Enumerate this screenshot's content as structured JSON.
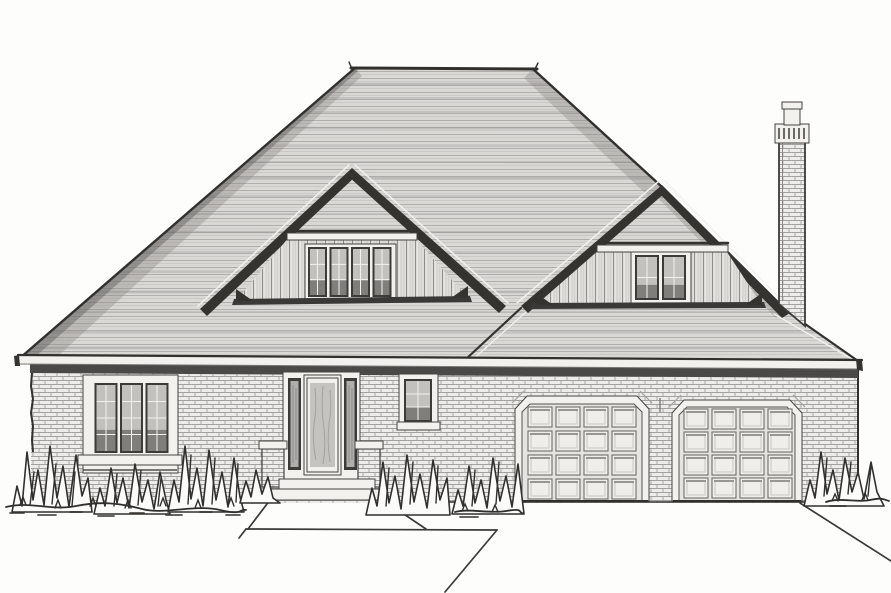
{
  "scene": {
    "title": "Black-and-white pen-and-ink front elevation drawing of a single-story brick house with a large hipped roof, two roof dormers with multi-pane windows, a tall brick chimney, an entry door with sidelights and stoop, a triple casement window, and an attached two-car garage with raised-panel doors, shrubs, walkway and driveway",
    "medium": "architectural elevation line rendering",
    "colors": {
      "paper": "#fdfdfc",
      "ink": "#31302d",
      "roof_fill": "#d9d8d5",
      "roof_hatch": "#b0afac",
      "roof_streak": "#9a9997",
      "fascia_dark": "#34332f",
      "trim_white": "#f2f1ee",
      "eave_shadow": "#4a4947",
      "brick_fill": "#edecea",
      "brick_line": "#a3a19d",
      "siding_fill": "#e7e6e3",
      "glass_light": "#c2c1be",
      "glass_dark": "#6e6d6a",
      "frame_dark": "#3c3b38",
      "panel_fill": "#efeeeb",
      "door_glass": "#c4c3c0"
    },
    "components": [
      "hipped-main-roof",
      "left-gable-dormer",
      "right-gable-dormer",
      "brick-chimney",
      "eave-fascia",
      "brick-wall",
      "triple-casement-window",
      "entry-door-with-sidelights",
      "brick-stoop-piers",
      "front-steps",
      "small-window",
      "two-car-garage",
      "raised-panel-garage-doors",
      "foundation-shrubs",
      "walkway",
      "driveway"
    ],
    "left_window": {
      "sash_count": 3,
      "muntin_cols": 2,
      "muntin_rows": 4
    },
    "small_window": {
      "muntin_cols": 2,
      "muntin_rows": 3
    },
    "left_dormer": {
      "window_count": 4
    },
    "right_dormer": {
      "window_count": 2
    },
    "garage": {
      "door_count": 2,
      "panel_cols": 4,
      "panel_rows": 4
    }
  },
  "generate": {
    "roof_streak_ys": [
      84,
      98,
      112,
      128,
      146,
      162,
      178,
      196,
      214,
      232,
      252,
      272,
      292,
      312,
      332,
      348
    ],
    "sash_groups": {
      "lw-sashes": {
        "xs": [
          94.5,
          120,
          145.5
        ],
        "y": 383,
        "w": 23,
        "h": 70,
        "mcols": 2,
        "mrows": 4
      },
      "dl-sashes": {
        "xs": [
          308,
          329.5,
          351,
          372.5
        ],
        "y": 247,
        "w": 19,
        "h": 50,
        "mcols": 2,
        "mrows": 3
      },
      "dr-sashes": {
        "xs": [
          635,
          662
        ],
        "y": 255,
        "w": 24,
        "h": 45,
        "mcols": 2,
        "mrows": 2
      },
      "sw-sashes": {
        "xs": [
          404
        ],
        "y": 379,
        "w": 28,
        "h": 43,
        "mcols": 2,
        "mrows": 3
      }
    },
    "garage_doors": [
      {
        "cols_x": [
          528,
          556,
          584,
          612
        ],
        "rows_y": [
          407,
          431,
          455,
          479
        ],
        "pw": 24,
        "ph": 20
      },
      {
        "cols_x": [
          684,
          712,
          740,
          768
        ],
        "rows_y": [
          409,
          432,
          455,
          478
        ],
        "pw": 24,
        "ph": 20
      }
    ]
  }
}
